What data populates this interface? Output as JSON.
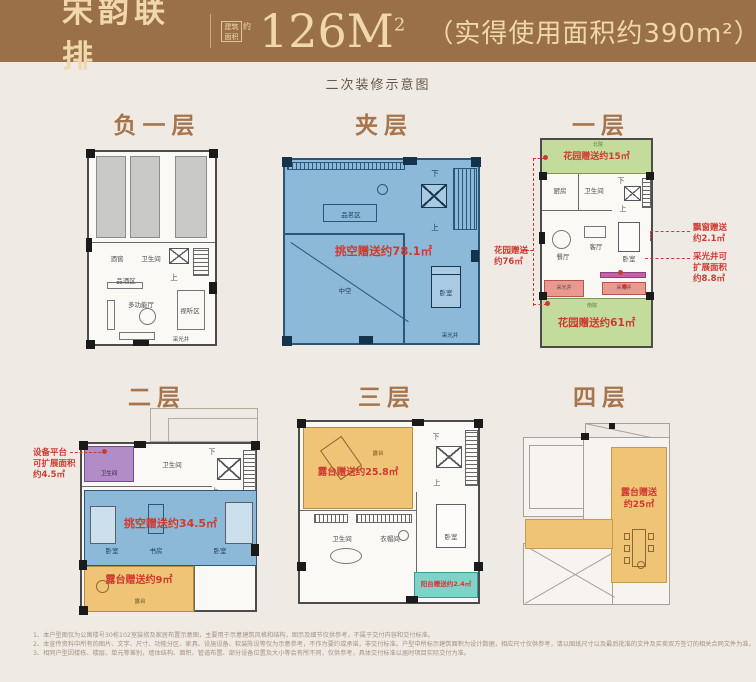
{
  "header": {
    "brand": "宋韵联排",
    "seal_line1": "建筑",
    "seal_line2": "面积",
    "seal_about": "约",
    "area": "126M",
    "area_sup": "2",
    "note": "（实得使用面积约390m²）"
  },
  "subtitle": "二次装修示意图",
  "colors": {
    "header_bg": "#9a7048",
    "header_fg": "#f0d8ac",
    "page_bg": "#f0eae5",
    "title_brown": "#a7754b",
    "annotation_red": "#cf3a30",
    "blue_fill": "#8db9d8",
    "green_fill": "#c3dc9c",
    "orange_fill": "#f0c477",
    "teal_fill": "#7fd2c8",
    "purple_fill": "#b18cc6",
    "pink_fill": "#e9998f",
    "magenta_fill": "#c263a8",
    "gray_fill": "#c9c9c7"
  },
  "floors": {
    "b1": {
      "title": "负一层",
      "rooms": {
        "wine": "酒窖",
        "bath": "卫生间",
        "tasting": "品酒区",
        "hall": "多功能厅",
        "av": "视听区",
        "well": "采光井"
      },
      "up": "上"
    },
    "jc": {
      "title": "夹层",
      "gift": "挑空赠送约78.1㎡",
      "rooms": {
        "tea": "品茗区",
        "void": "中空",
        "bed": "卧室",
        "well": "采光井"
      },
      "up": "上",
      "down": "下"
    },
    "f1": {
      "title": "一层",
      "gift_top": "花园赠送约15㎡",
      "gift_bottom": "花园赠送约61㎡",
      "ann_left": [
        "花园赠送",
        "约76㎡"
      ],
      "ann_bay": [
        "飘窗赠送",
        "约2.1㎡"
      ],
      "ann_well": [
        "采光井可",
        "扩展面积",
        "约8.8㎡"
      ],
      "rooms": {
        "north": "北院",
        "kitchen": "厨房",
        "bath": "卫生间",
        "dining": "餐厅",
        "living": "客厅",
        "bed": "卧室",
        "well_l": "采光井",
        "well_r": "采光井",
        "south": "南院"
      },
      "up": "上",
      "down": "下"
    },
    "f2": {
      "title": "二层",
      "gift_mid": "挑空赠送约34.5㎡",
      "gift_terrace": "露台赠送约9㎡",
      "ann_left": [
        "设备平台",
        "可扩展面积",
        "约4.5㎡"
      ],
      "rooms": {
        "bath1": "卫生间",
        "bath2": "卫生间",
        "bed1": "卧室",
        "study": "书房",
        "bed2": "卧室",
        "terrace": "露台"
      },
      "up": "上",
      "down": "下"
    },
    "f3": {
      "title": "三层",
      "gift_terrace": "露台赠送约25.8㎡",
      "gift_balcony": "阳台赠送约2.4㎡",
      "rooms": {
        "terrace": "露台",
        "bath": "卫生间",
        "closet": "衣帽间",
        "bed": "卧室"
      },
      "up": "上",
      "down": "下"
    },
    "f4": {
      "title": "四层",
      "gift": [
        "露台赠送",
        "约25㎡"
      ]
    }
  },
  "disclaimer": [
    "1、本户型图仅为公寓楼号30栋102室装修及家居布置示意图，主要用于示意建筑风格和结构，图示及细节仅供参考，不属于交付内容和交付标准。",
    "2、本宣传资料中所有的图片、文字、尺寸、功能分区、家具、设施设备、软装陈设等仅为示意参考，不作为要约或承诺，非交付标准。户型中所标示建筑面积为设计数据，相应尺寸仅供参考，请以图纸尺寸以及最后批准的文件及买卖双方签订的相关合同文件为准。",
    "3、相同户型因楼栋、楼层、单元等差别，墙体结构、面积、管道布置、部分设备位置及大小等会有所不同，仅供参考，具体交付标准以届时项目实际交付为准。"
  ]
}
